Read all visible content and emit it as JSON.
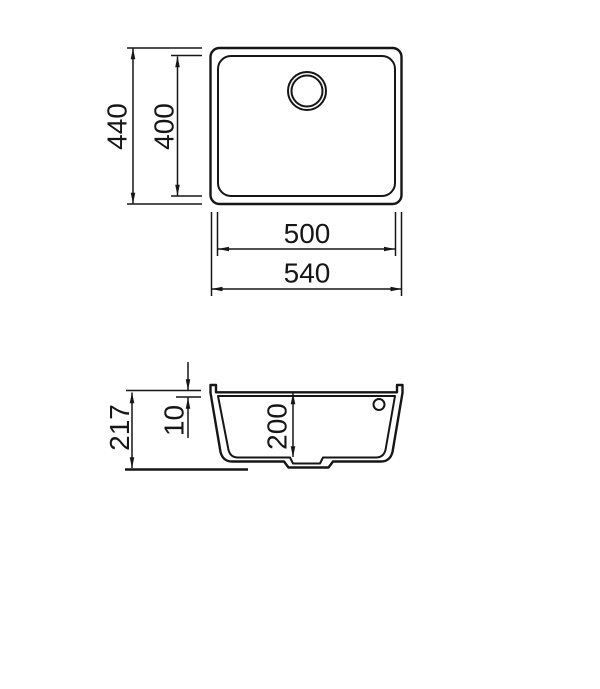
{
  "page": {
    "background": "#ffffff",
    "line_color": "#161616"
  },
  "top_view": {
    "overall_height": "440",
    "bowl_height": "400",
    "bowl_width": "500",
    "overall_width": "540"
  },
  "section_view": {
    "overall_depth": "217",
    "rim_height": "10",
    "bowl_depth": "200"
  }
}
